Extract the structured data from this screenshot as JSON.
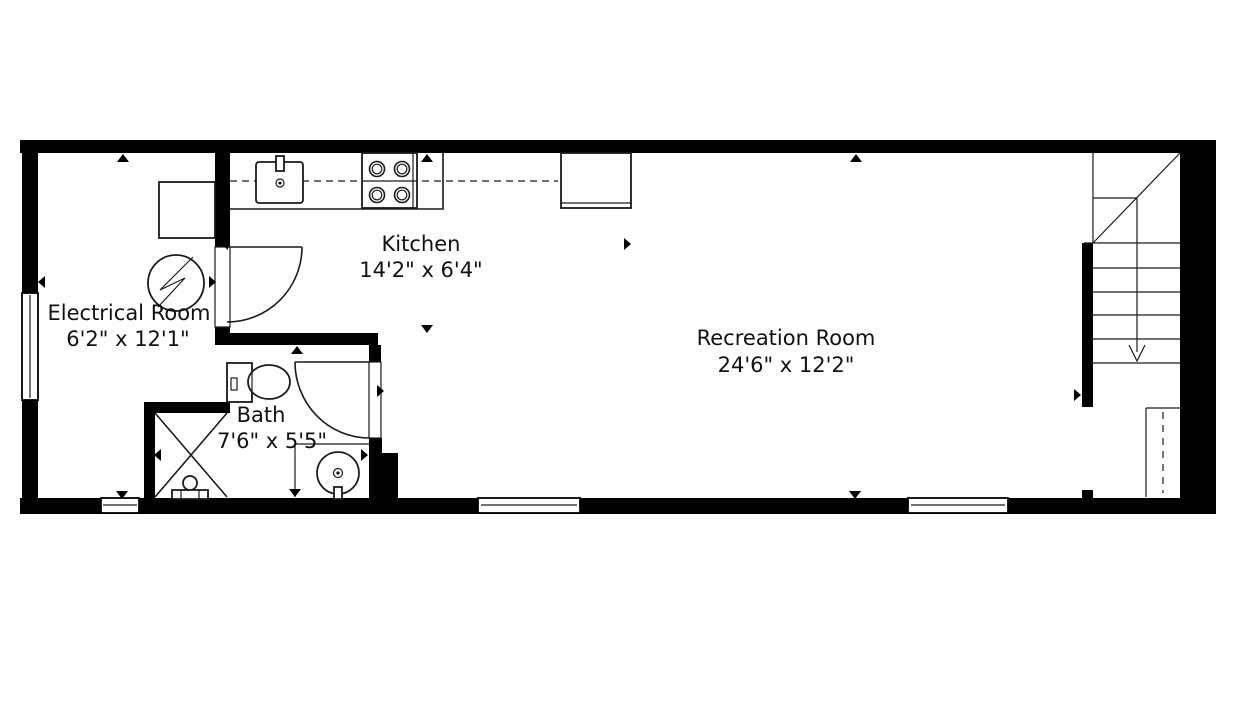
{
  "plan": {
    "background_color": "#ffffff",
    "wall_color": "#000000",
    "line_color": "#1a1a1a",
    "rooms": [
      {
        "name": "Electrical Room",
        "dimensions": "6'2\" x 12'1\""
      },
      {
        "name": "Kitchen",
        "dimensions": "14'2\" x 6'4\""
      },
      {
        "name": "Bath",
        "dimensions": "7'6\" x 5'5\""
      },
      {
        "name": "Recreation Room",
        "dimensions": "24'6\" x 12'2\""
      }
    ],
    "fixtures": [
      "electrical-panel",
      "appliance-box",
      "kitchen-sink",
      "stove-4-burner",
      "refrigerator",
      "kitchen-counter",
      "toilet",
      "shower-stall",
      "pedestal-sink",
      "vanity",
      "staircase",
      "closet"
    ],
    "stairs": {
      "direction_arrow": "down"
    },
    "windows": {
      "count": 4
    },
    "doors": {
      "count": 2
    }
  }
}
